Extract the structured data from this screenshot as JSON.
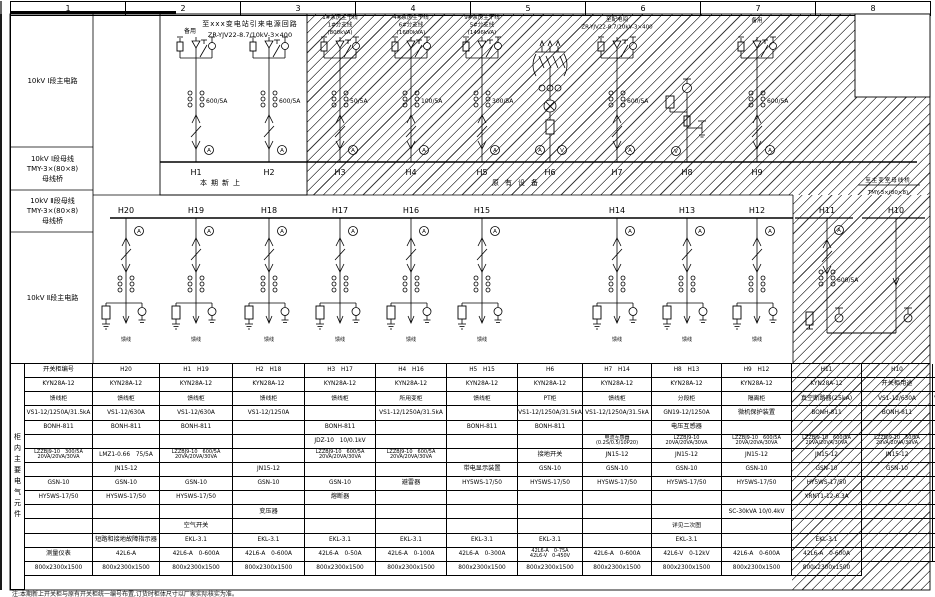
{
  "frame": {
    "columns": [
      "1",
      "2",
      "3",
      "4",
      "5",
      "6",
      "7",
      "8"
    ]
  },
  "left_labels": {
    "a": "10kV Ⅰ段主电路",
    "b": "10kV Ⅰ段母线\nTMY-3×(80×8)\n母线桥",
    "c": "10kV Ⅱ段母线\nTMY-3×(80×8)\n母线桥",
    "d": "10kV Ⅱ段主电路"
  },
  "diagram": {
    "texts": {
      "incoming1": "至xxx变电站引来电源回路",
      "incoming2": "ZR-YJV22-8.7/10kV-3×400",
      "spare": "备用",
      "new_phase": "本期新上",
      "existing": "原有设备",
      "bridge1": "至主变室母线桥",
      "bridge2": "TMY-3×(80×8)",
      "cable": "馈线"
    },
    "section1_feeders": [
      {
        "id": "H1",
        "x": 196,
        "type": "in",
        "ct": "600/5A"
      },
      {
        "id": "H2",
        "x": 269,
        "type": "in",
        "ct": "600/5A"
      },
      {
        "id": "H3",
        "x": 340,
        "type": "in",
        "ct": "50/5A",
        "note": [
          "1#泵房主干线",
          "1#分支线",
          "(800kVA)"
        ]
      },
      {
        "id": "H4",
        "x": 411,
        "type": "in",
        "ct": "100/5A",
        "note": [
          "4#泵房主干线",
          "6#分支线",
          "(1600kVA)"
        ]
      },
      {
        "id": "H5",
        "x": 482,
        "type": "in",
        "ct": "300/5A",
        "note": [
          "9#泵房主干线",
          "5#分支线",
          "(1496kVA)"
        ]
      },
      {
        "id": "H6",
        "x": 550,
        "type": "txf"
      },
      {
        "id": "H7",
        "x": 617,
        "type": "in",
        "ct": "600/5A",
        "note": [
          "至配电间",
          "ZR-YJV22-8.7/10kV-3×400"
        ]
      },
      {
        "id": "H8",
        "x": 687,
        "type": "pt"
      },
      {
        "id": "H9",
        "x": 757,
        "type": "in",
        "ct": "600/5A",
        "note": [
          "备用"
        ]
      }
    ],
    "section2_feeders": [
      {
        "id": "H20",
        "x": 126
      },
      {
        "id": "H19",
        "x": 196
      },
      {
        "id": "H18",
        "x": 269
      },
      {
        "id": "H17",
        "x": 340
      },
      {
        "id": "H16",
        "x": 411
      },
      {
        "id": "H15",
        "x": 482
      },
      {
        "id": "H14",
        "x": 617
      },
      {
        "id": "H13",
        "x": 687
      },
      {
        "id": "H12",
        "x": 757
      }
    ],
    "tie": {
      "h11": {
        "id": "H11",
        "x": 827,
        "ct": "600/5A"
      },
      "h10": {
        "id": "H10",
        "x": 896
      }
    }
  },
  "table": {
    "side_label": "柜内主要电气元件",
    "col_widths": [
      68,
      67,
      73,
      72,
      71,
      71,
      71,
      65,
      69,
      70,
      70,
      70,
      71,
      67
    ],
    "rows": [
      {
        "label": "开关柜编号",
        "values": [
          "H20",
          "H1　H19",
          "H2　H18",
          "H3　H17",
          "H4　H16",
          "H5　H15",
          "H6",
          "H7　H14",
          "H8　H13",
          "H9　H12",
          "H11",
          "H10"
        ]
      },
      {
        "label": "开关柜型号",
        "values": [
          "KYN28A-12",
          "KYN28A-12",
          "KYN28A-12",
          "KYN28A-12",
          "KYN28A-12",
          "KYN28A-12",
          "KYN28A-12",
          "KYN28A-12",
          "KYN28A-12",
          "KYN28A-12",
          "KYN28A-12",
          "KYN28A-12"
        ]
      },
      {
        "label": "开关柜用途",
        "values": [
          "馈线柜",
          "馈线柜",
          "馈线柜",
          "馈线柜",
          "馈线柜",
          "馈线柜",
          "所用变柜",
          "馈线柜",
          "PT柜",
          "馈线柜",
          "分段柜",
          "隔离柜"
        ]
      },
      {
        "label": "真空断路器(25kA)",
        "values": [
          "VS1-12/630A",
          "VS1-12/1250A/31.5kA",
          "VS1-12/1250A/31.5kA",
          "VS1-12/630A",
          "VS1-12/630A",
          "VS1-12/1250A",
          "",
          "VS1-12/1250A/31.5kA",
          "",
          "VS1-12/1250A/31.5kA",
          "VS1-12/1250A/31.5kA",
          "GN19-12/1250A"
        ]
      },
      {
        "label": "微机保护装置",
        "values": [
          "BONH-811",
          "BONH-811",
          "BONH-811",
          "BONH-811",
          "BONH-811",
          "BONH-811",
          "",
          "BONH-811",
          "",
          "BONH-811",
          "BONH-811",
          ""
        ]
      },
      {
        "label": "电压互感器",
        "values": [
          "",
          "",
          "",
          "",
          "",
          "",
          "",
          "",
          "JDZ-10　10/0.1kV",
          "",
          "",
          ""
        ]
      },
      {
        "label": "电流互感器\n(0.2S/0.5/10P20)",
        "values": [
          "LZZBJ9-10\n20VA/20VA/30VA",
          "LZZBJ9-10　600/5A\n20VA/20VA/30VA",
          "LZZBJ9-10　600/5A\n20VA/20VA/30VA",
          "LZZBJ9-10　50/5A\n20VA/20VA/30VA",
          "LZZBJ9-10　100/5A\n20VA/20VA/30VA",
          "LZZBJ9-10　300/5A\n20VA/20VA/30VA",
          "LMZ1-0.66　75/5A",
          "LZZBJ9-10　600/5A\n20VA/20VA/30VA",
          "",
          "LZZBJ9-10　600/5A\n20VA/20VA/30VA",
          "LZZBJ9-10　600/5A\n20VA/20VA/30VA",
          ""
        ]
      },
      {
        "label": "接地开关",
        "values": [
          "JN15-12",
          "JN15-12",
          "JN15-12",
          "JN15-12",
          "JN15-12",
          "JN15-12",
          "",
          "JN15-12",
          "",
          "JN15-12",
          "",
          ""
        ]
      },
      {
        "label": "带电显示装置",
        "values": [
          "GSN-10",
          "GSN-10",
          "GSN-10",
          "GSN-10",
          "GSN-10",
          "GSN-10",
          "",
          "GSN-10",
          "GSN-10",
          "GSN-10",
          "GSN-10",
          "GSN-10"
        ]
      },
      {
        "label": "避雷器",
        "values": [
          "HY5WS-17/50",
          "HY5WS-17/50",
          "HY5WS-17/50",
          "HY5WS-17/50",
          "HY5WS-17/50",
          "HY5WS-17/50",
          "",
          "HY5WS-17/50",
          "HY5WS-17/50",
          "HY5WS-17/50",
          "HY5WS-17/50",
          ""
        ]
      },
      {
        "label": "熔断器",
        "values": [
          "",
          "",
          "",
          "",
          "",
          "",
          "XRNT1-12-6.3A",
          "",
          "XRNP1-12-0.5A",
          "",
          "",
          ""
        ]
      },
      {
        "label": "变压器",
        "values": [
          "",
          "",
          "",
          "",
          "",
          "",
          "SC-30kVA 10/0.4kV",
          "",
          "",
          "",
          "",
          ""
        ]
      },
      {
        "label": "空气开关",
        "values": [
          "",
          "",
          "",
          "",
          "",
          "",
          "详见二次图",
          "",
          "",
          "",
          "",
          ""
        ]
      },
      {
        "label": "短路和接地故障指示器",
        "values": [
          "EKL-3.1",
          "EKL-3.1",
          "EKL-3.1",
          "EKL-3.1",
          "EKL-3.1",
          "EKL-3.1",
          "",
          "EKL-3.1",
          "",
          "EKL-3.1",
          "",
          ""
        ]
      },
      {
        "label": "测量仪表",
        "values": [
          "42L6-A",
          "42L6-A　0-600A",
          "42L6-A　0-600A",
          "42L6-A　0-50A",
          "42L6-A　0-100A",
          "42L6-A　0-300A",
          "42L6-A　0-75A\n42L6-V　0-450V",
          "42L6-A　0-600A",
          "42L6-V　0-12kV",
          "42L6-A　0-600A",
          "42L6-A　0-600A",
          ""
        ]
      },
      {
        "label": "开关柜尺寸(宽x深x高)",
        "values": [
          "800x2300x1500",
          "800x2300x1500",
          "800x2300x1500",
          "800x2300x1500",
          "800x2300x1500",
          "800x2300x1500",
          "800x2300x1500",
          "800x2300x1500",
          "800x2300x1500",
          "800x2300x1500",
          "800x2300x1500",
          "800x2300x1500"
        ]
      }
    ]
  },
  "note": "注:本期新上开关柜与原有开关柜统一编号布置,订货时柜体尺寸以厂家实际核实为准。"
}
